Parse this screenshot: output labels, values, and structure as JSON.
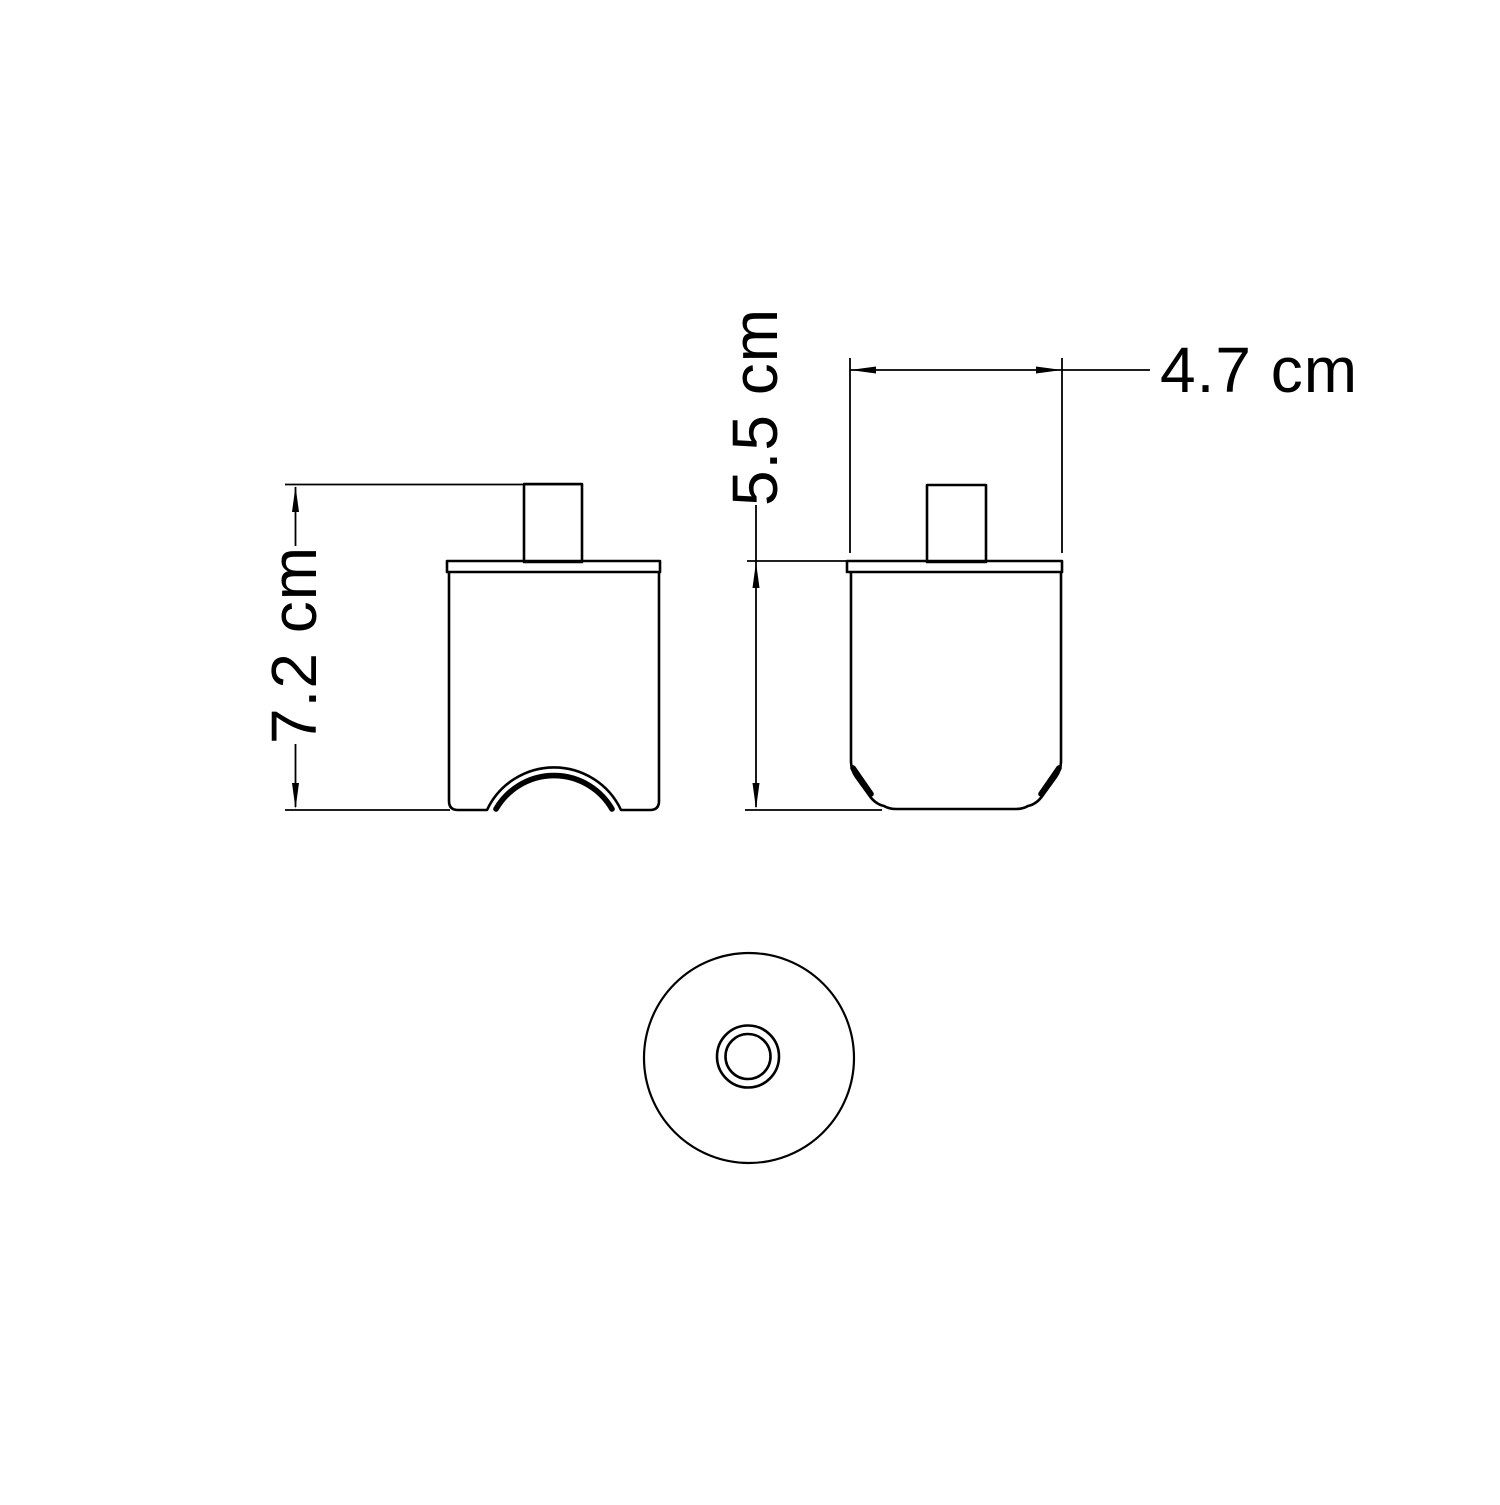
{
  "drawing": {
    "kind": "orthographic-technical-drawing",
    "background_color": "#ffffff",
    "line_color": "#000000",
    "views": {
      "front": {
        "name": "front view",
        "height_label": "7.2 cm"
      },
      "side": {
        "name": "side view",
        "height_label": "5.5 cm",
        "width_label": "4.7 cm"
      },
      "bottom": {
        "name": "bottom view",
        "features": "outer disc with concentric center hole ring"
      }
    }
  }
}
